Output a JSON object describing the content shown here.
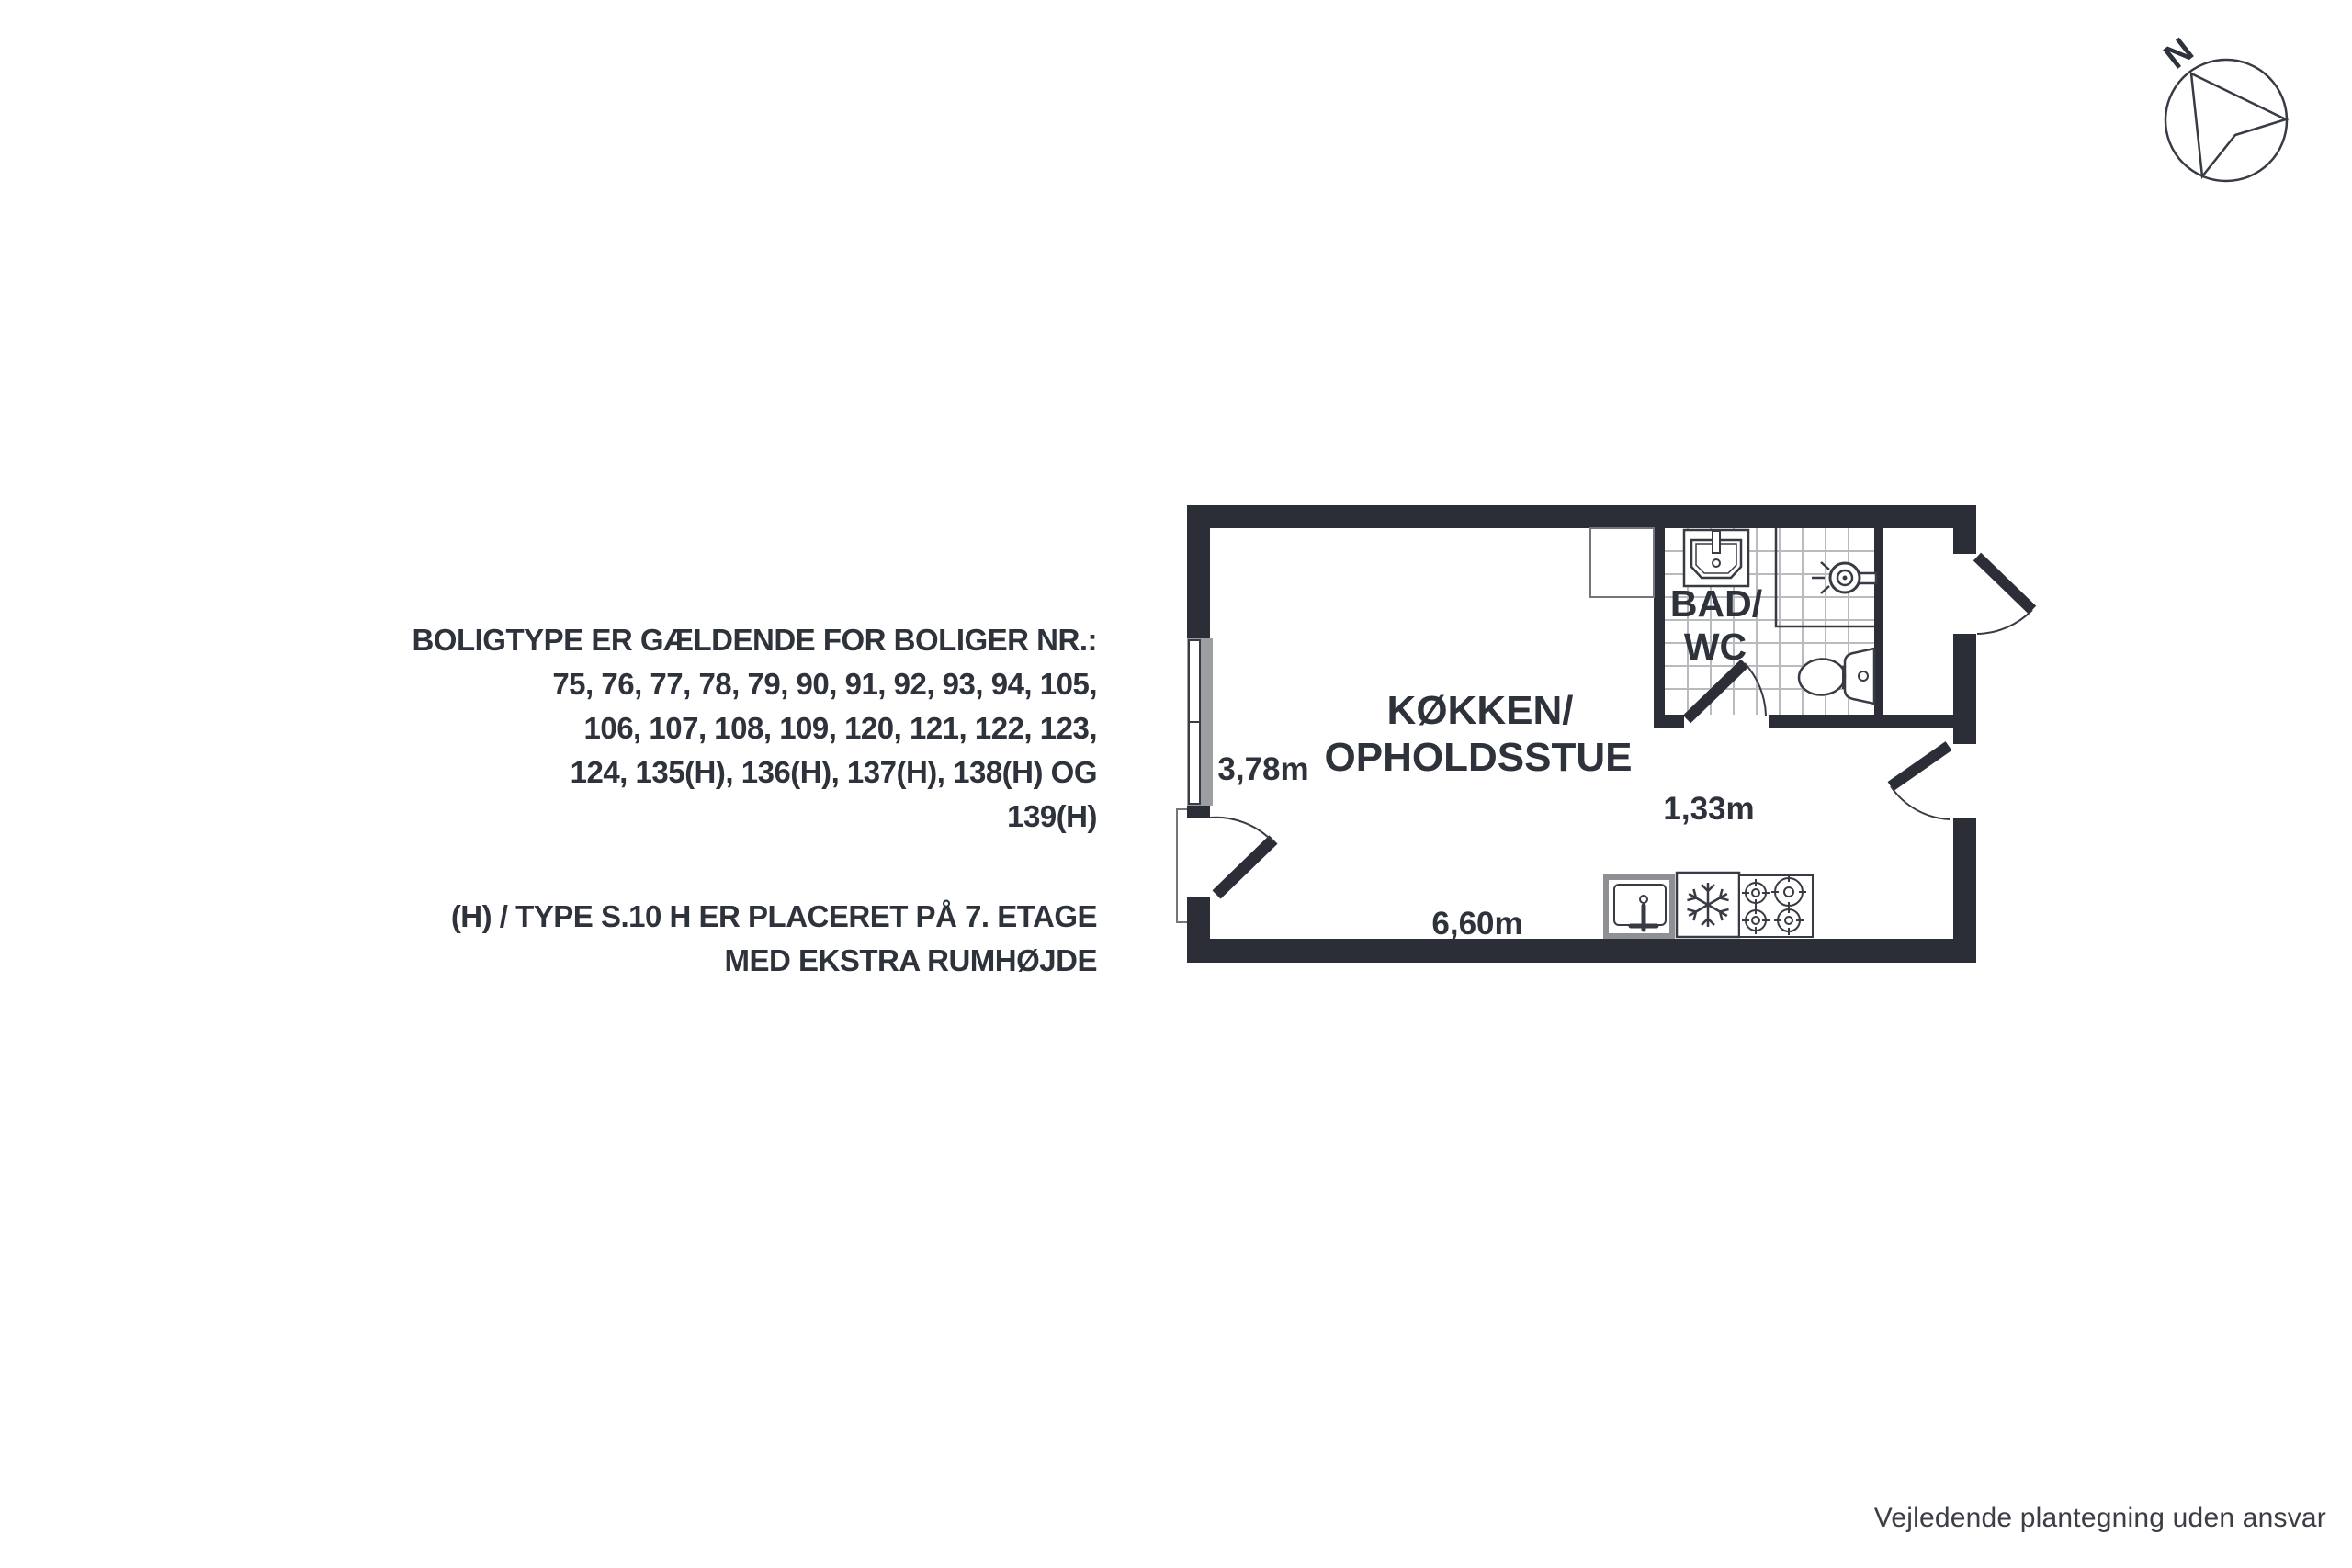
{
  "compass": {
    "label": "N"
  },
  "notes": {
    "applies_to": [
      "BOLIGTYPE ER GÆLDENDE FOR BOLIGER NR.:",
      "75, 76, 77, 78, 79, 90, 91, 92, 93, 94, 105,",
      "106, 107, 108, 109, 120, 121, 122, 123,",
      "124, 135(H), 136(H), 137(H), 138(H) OG",
      "139(H)"
    ],
    "placement": [
      "(H) / TYPE S.10 H ER PLACERET PÅ 7. ETAGE",
      "MED EKSTRA RUMHØJDE"
    ]
  },
  "floor_plan": {
    "rooms": {
      "kitchen_living": {
        "label_line1": "KØKKEN/",
        "label_line2": "OPHOLDSSTUE"
      },
      "bathroom": {
        "label_line1": "BAD/",
        "label_line2": "WC"
      }
    },
    "dimensions": {
      "room_width": "3,78m",
      "bath_width": "1,33m",
      "room_length": "6,60m"
    },
    "fixtures": [
      "bath-sink",
      "shower",
      "toilet",
      "wardrobe",
      "kitchen-sink",
      "fridge",
      "stove"
    ]
  },
  "footer": {
    "disclaimer": "Vejledende plantegning uden ansvar"
  },
  "colors": {
    "wall": "#2b2e37",
    "outline": "#383b44",
    "window_gray": "#9c9ea1",
    "counter_gray": "#8e9094",
    "tile_line": "#b9bbbe",
    "text": "#2e323b"
  }
}
